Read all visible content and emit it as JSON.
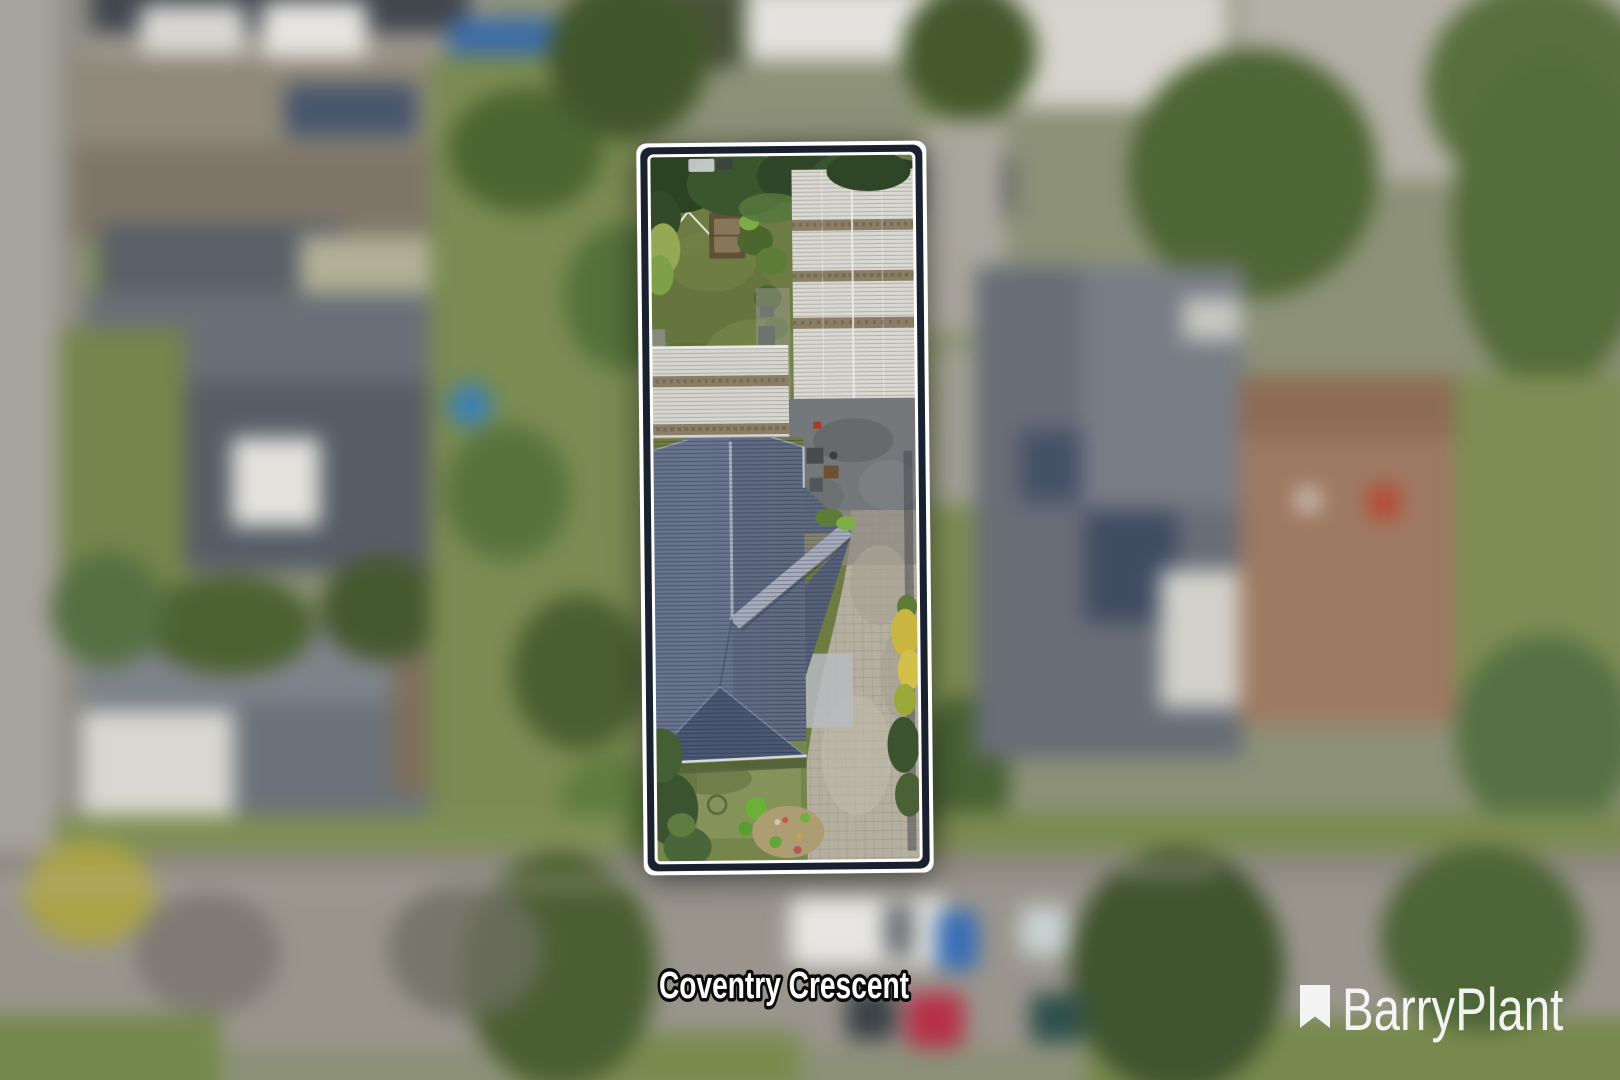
{
  "palette": {
    "outer": "#ffffff",
    "band": "#18212d",
    "label_fill": "#ffffff",
    "label_stroke": "#0b0b0b",
    "brand_color": "#f7f8f8"
  },
  "street_label": {
    "text": "Coventry Crescent"
  },
  "watermark": {
    "brand": "BarryPlant",
    "icon": "bookmark-icon"
  },
  "scene": {
    "description": "Aerial drone photograph of a suburban block; the subject property is outlined with a white double border and shown sharp while all surroundings are blurred",
    "subject_lot": {
      "boundary_style": "white outer stroke, dark navy band, white inner stroke",
      "features": [
        "backyard lawn",
        "rotary clothesline",
        "picnic table",
        "two white corrugated shed roofs",
        "dark asphalt courtyard",
        "blue-grey tiled hip roof house",
        "paved driveway",
        "front lawn with garden beds",
        "yellow flowering shrubs"
      ]
    }
  }
}
